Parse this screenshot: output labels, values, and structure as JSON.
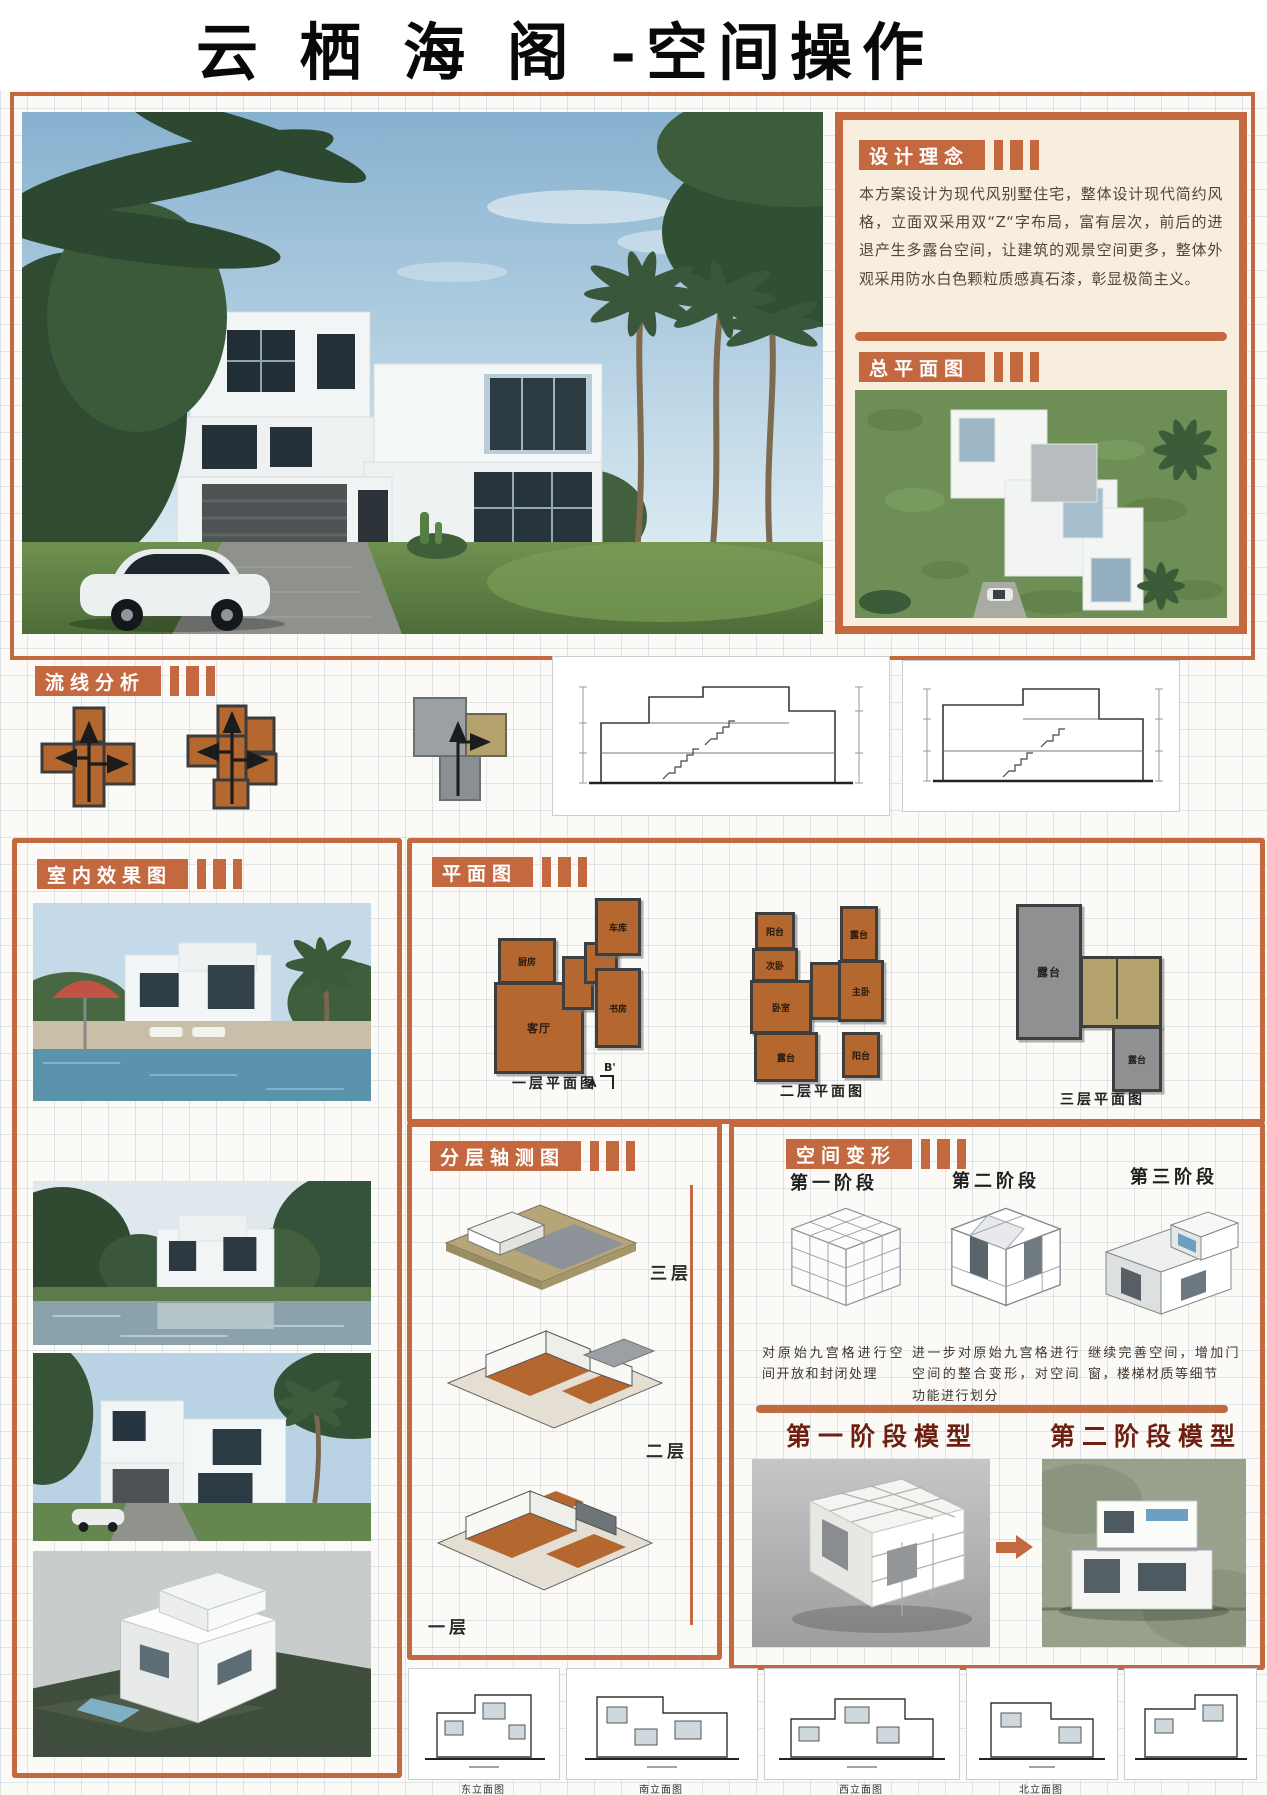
{
  "title": "云 栖 海 阁 -空间操作",
  "concept": {
    "heading": "设计理念",
    "body": "本方案设计为现代风别墅住宅，整体设计现代简约风格，立面双采用双“Z“字布局，富有层次，前后的进退产生多露台空间，让建筑的观景空间更多，整体外观采用防水白色颗粒质感真石漆，彰显极简主义。"
  },
  "site": {
    "heading": "总平面图"
  },
  "flow": {
    "heading": "流线分析"
  },
  "interior": {
    "heading": "室内效果图"
  },
  "plan": {
    "heading": "平面图",
    "f1": {
      "caption": "一层平面图",
      "kitchen": "厨房",
      "living": "客厅",
      "study": "书房",
      "garage": "车库",
      "markA": "A",
      "markB": "B'"
    },
    "f2": {
      "caption": "二层平面图",
      "balcony_a": "阳台",
      "bed2": "次卧",
      "bed": "卧室",
      "terrace_a": "露台",
      "master": "主卧",
      "balcony_b": "阳台",
      "terrace_b": "露台"
    },
    "f3": {
      "caption": "三层平面图",
      "terrace_big": "露台",
      "terrace_small": "露台"
    }
  },
  "axon": {
    "heading": "分层轴测图",
    "l3": "三层",
    "l2": "二层",
    "l1": "一层"
  },
  "morph": {
    "heading": "空间变形",
    "s1": {
      "label": "第一阶段",
      "desc": "对原始九宫格进行空间开放和封闭处理"
    },
    "s2": {
      "label": "第二阶段",
      "desc": "进一步对原始九宫格进行空间的整合变形，对空间功能进行划分"
    },
    "s3": {
      "label": "第三阶段",
      "desc": "继续完善空间，增加门窗，楼梯材质等细节"
    }
  },
  "model": {
    "m1": "第一阶段模型",
    "m2": "第二阶段模型"
  },
  "elev": {
    "e1": "东立面图",
    "e2": "南立面图",
    "e3": "西立面图",
    "e4": "北立面图"
  }
}
